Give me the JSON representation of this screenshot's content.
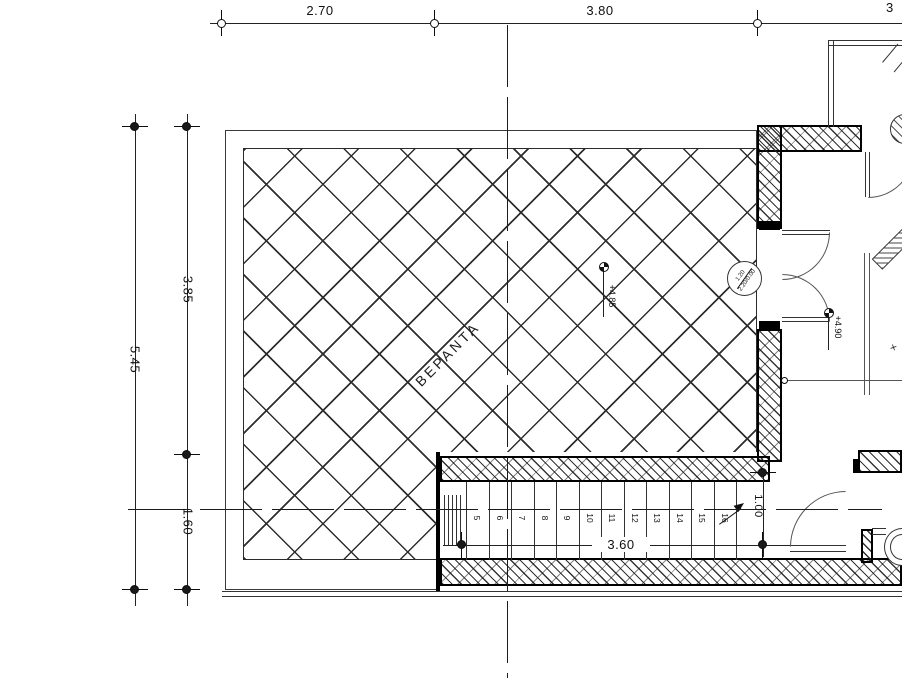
{
  "labels": {
    "room": "ΒΕΡΑΝΤΑ",
    "x_marks": "×"
  },
  "dims": {
    "top": [
      {
        "label": "2.70"
      },
      {
        "label": "3.80"
      },
      {
        "label": "3"
      }
    ],
    "left": [
      {
        "label": "5.45"
      },
      {
        "label": "3.85"
      },
      {
        "label": "1.60"
      }
    ],
    "stair": {
      "width": "3.60",
      "landing": "1.00"
    }
  },
  "elevations": {
    "veranda": "+4.85",
    "interior": "+4.90"
  },
  "door_tag": {
    "top": "1.20",
    "bottom": "2.20/0.00"
  },
  "stairs": {
    "steps": [
      "5",
      "6",
      "7",
      "8",
      "9",
      "10",
      "11",
      "12",
      "13",
      "14",
      "15",
      "16"
    ]
  }
}
